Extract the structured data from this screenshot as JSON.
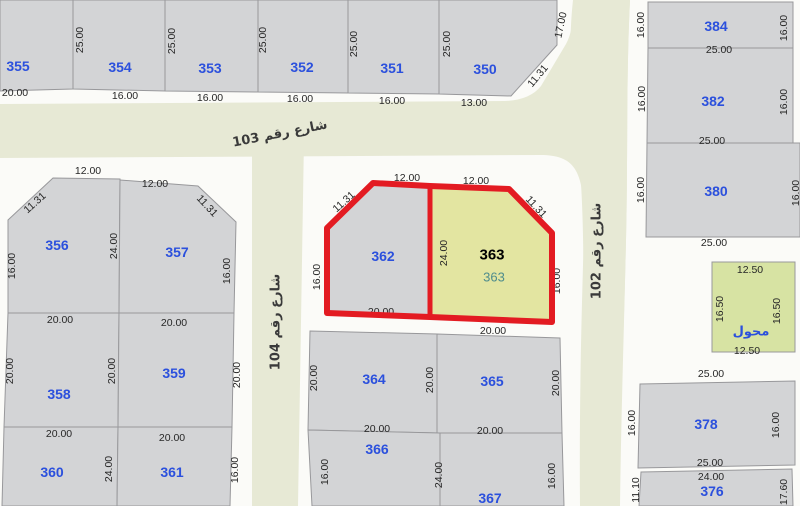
{
  "map": {
    "colors": {
      "ground": "#fbfbf8",
      "street_fill": "#e7e9d5",
      "plot": "#d3d4d6",
      "plot_stroke": "#98989b",
      "selected": "#e3e5a1",
      "utility": "#d7e3a3",
      "plot_number": "#2b50dd",
      "dim_text": "#272727",
      "street_text": "#3a3a3a",
      "highlight": "#e31b22",
      "selected_number": "#000000",
      "selected_sub": "#4e8c8c"
    },
    "streets": [
      {
        "id": "103-102",
        "label": "شارع رقم 103",
        "shape": "M0,104 L505,101 Q530,100 541,86 L566,44 Q572,33 573,16 L573,0 L630,0 C626,80 628,160 626,240 C624,330 621,420 620,506 L580,506 C579,400 582,300 584,230 C585,170 575,155 540,155 L0,158 Z",
        "label_x": 280,
        "label_y": 134,
        "label_rot": -11
      },
      {
        "id": "102",
        "label": "شارع رقم 102",
        "shape": "M573,0 C567,55 572,120 580,170 C585,230 584,330 582,506 L619,506 C620,420 624,330 626,240 C628,160 626,80 630,0 Z",
        "label_x": 597,
        "label_y": 251,
        "label_rot": -90
      },
      {
        "id": "104",
        "label": "شارع رقم 104",
        "shape": "M252,138 L304,138 L298,506 L252,506 Z",
        "label_x": 276,
        "label_y": 322,
        "label_rot": -90
      }
    ],
    "plots": [
      {
        "id": "355",
        "points": "0,0 73,0 73,89 0,91",
        "num": "355",
        "nx": 18,
        "ny": 66
      },
      {
        "id": "354",
        "points": "73,0 165,0 165,91 73,89",
        "num": "354",
        "nx": 120,
        "ny": 67
      },
      {
        "id": "353",
        "points": "165,0 258,0 258,92 165,91",
        "num": "353",
        "nx": 210,
        "ny": 68
      },
      {
        "id": "352",
        "points": "258,0 348,0 348,93 258,92",
        "num": "352",
        "nx": 302,
        "ny": 67
      },
      {
        "id": "351",
        "points": "348,0 439,0 439,94 348,93",
        "num": "351",
        "nx": 392,
        "ny": 68
      },
      {
        "id": "350",
        "points": "439,0 557,0 557,45 511,96 439,94",
        "num": "350",
        "nx": 485,
        "ny": 69
      },
      {
        "id": "384",
        "points": "648,2 793,2 793,48 648,48",
        "num": "384",
        "nx": 716,
        "ny": 26
      },
      {
        "id": "382",
        "points": "648,48 793,48 793,143 647,143",
        "num": "382",
        "nx": 713,
        "ny": 101
      },
      {
        "id": "380",
        "points": "647,143 800,143 800,237 646,237",
        "num": "380",
        "nx": 716,
        "ny": 191
      },
      {
        "id": "transformer",
        "points": "712,262 795,262 795,352 712,352",
        "fill": "utility",
        "num": "محول",
        "nx": 751,
        "ny": 332,
        "arabic": true
      },
      {
        "id": "378",
        "points": "640,384 795,381 795,465 638,468",
        "num": "378",
        "nx": 706,
        "ny": 424
      },
      {
        "id": "376",
        "points": "641,472 792,469 793,506 639,506",
        "num": "376",
        "nx": 712,
        "ny": 491
      },
      {
        "id": "356",
        "points": "8,220 53,178 120,179 119,313 8,313",
        "num": "356",
        "nx": 57,
        "ny": 245
      },
      {
        "id": "357",
        "points": "120,180 198,186 236,222 234,313 119,313",
        "num": "357",
        "nx": 177,
        "ny": 252
      },
      {
        "id": "358",
        "points": "8,313 119,313 118,427 4,427",
        "num": "358",
        "nx": 59,
        "ny": 394
      },
      {
        "id": "359",
        "points": "119,313 234,313 232,427 118,427",
        "num": "359",
        "nx": 174,
        "ny": 373
      },
      {
        "id": "360",
        "points": "4,427 118,427 117,506 2,506",
        "num": "360",
        "nx": 52,
        "ny": 472
      },
      {
        "id": "361",
        "points": "118,427 232,427 230,506 117,506",
        "num": "361",
        "nx": 172,
        "ny": 472
      },
      {
        "id": "362",
        "points": "327,228 373,183 430,186 430,317 327,313",
        "num": "362",
        "nx": 383,
        "ny": 256
      },
      {
        "id": "363",
        "points": "430,186 509,189 552,233 552,322 430,317",
        "fill": "selected"
      },
      {
        "id": "364",
        "points": "310,331 437,334 437,433 308,430",
        "num": "364",
        "nx": 374,
        "ny": 379
      },
      {
        "id": "365",
        "points": "437,334 560,338 562,433 437,433",
        "num": "365",
        "nx": 492,
        "ny": 381
      },
      {
        "id": "366",
        "points": "308,430 440,433 440,506 312,506",
        "num": "366",
        "nx": 377,
        "ny": 449
      },
      {
        "id": "367",
        "points": "440,433 562,433 564,506 440,506",
        "num": "367",
        "nx": 490,
        "ny": 498
      }
    ],
    "dims": [
      {
        "t": "20.00",
        "x": 15,
        "y": 93
      },
      {
        "t": "16.00",
        "x": 125,
        "y": 96
      },
      {
        "t": "16.00",
        "x": 210,
        "y": 98
      },
      {
        "t": "16.00",
        "x": 300,
        "y": 99
      },
      {
        "t": "16.00",
        "x": 392,
        "y": 101
      },
      {
        "t": "13.00",
        "x": 474,
        "y": 103
      },
      {
        "t": "25.00",
        "x": 80,
        "y": 40,
        "r": -90
      },
      {
        "t": "25.00",
        "x": 172,
        "y": 41,
        "r": -90
      },
      {
        "t": "25.00",
        "x": 263,
        "y": 40,
        "r": -90
      },
      {
        "t": "25.00",
        "x": 354,
        "y": 44,
        "r": -90
      },
      {
        "t": "25.00",
        "x": 447,
        "y": 44,
        "r": -90
      },
      {
        "t": "11.31",
        "x": 538,
        "y": 76,
        "r": -50
      },
      {
        "t": "17.00",
        "x": 561,
        "y": 25,
        "r": -78
      },
      {
        "t": "16.00",
        "x": 641,
        "y": 25,
        "r": -90
      },
      {
        "t": "16.00",
        "x": 784,
        "y": 28,
        "r": -90
      },
      {
        "t": "25.00",
        "x": 719,
        "y": 50
      },
      {
        "t": "16.00",
        "x": 642,
        "y": 99,
        "r": -90
      },
      {
        "t": "16.00",
        "x": 784,
        "y": 102,
        "r": -90
      },
      {
        "t": "25.00",
        "x": 712,
        "y": 141
      },
      {
        "t": "16.00",
        "x": 641,
        "y": 190,
        "r": -90
      },
      {
        "t": "16.00",
        "x": 796,
        "y": 193,
        "r": -90
      },
      {
        "t": "25.00",
        "x": 714,
        "y": 243
      },
      {
        "t": "12.50",
        "x": 750,
        "y": 270
      },
      {
        "t": "16.50",
        "x": 720,
        "y": 309,
        "r": -90
      },
      {
        "t": "16.50",
        "x": 777,
        "y": 311,
        "r": -90
      },
      {
        "t": "12.50",
        "x": 747,
        "y": 351
      },
      {
        "t": "25.00",
        "x": 711,
        "y": 374
      },
      {
        "t": "16.00",
        "x": 632,
        "y": 423,
        "r": -90
      },
      {
        "t": "16.00",
        "x": 776,
        "y": 425,
        "r": -90
      },
      {
        "t": "25.00",
        "x": 710,
        "y": 463
      },
      {
        "t": "24.00",
        "x": 711,
        "y": 477
      },
      {
        "t": "11.10",
        "x": 636,
        "y": 490,
        "r": -90
      },
      {
        "t": "17.60",
        "x": 784,
        "y": 492,
        "r": -90
      },
      {
        "t": "12.00",
        "x": 88,
        "y": 171
      },
      {
        "t": "11.31",
        "x": 35,
        "y": 203,
        "r": -42
      },
      {
        "t": "12.00",
        "x": 155,
        "y": 184
      },
      {
        "t": "11.31",
        "x": 207,
        "y": 206,
        "r": 47
      },
      {
        "t": "24.00",
        "x": 114,
        "y": 246,
        "r": -90
      },
      {
        "t": "16.00",
        "x": 12,
        "y": 266,
        "r": -90
      },
      {
        "t": "16.00",
        "x": 227,
        "y": 271,
        "r": -90
      },
      {
        "t": "20.00",
        "x": 60,
        "y": 320
      },
      {
        "t": "20.00",
        "x": 174,
        "y": 323
      },
      {
        "t": "20.00",
        "x": 10,
        "y": 371,
        "r": -90
      },
      {
        "t": "20.00",
        "x": 112,
        "y": 371,
        "r": -90
      },
      {
        "t": "20.00",
        "x": 237,
        "y": 375,
        "r": -90
      },
      {
        "t": "20.00",
        "x": 59,
        "y": 434
      },
      {
        "t": "20.00",
        "x": 172,
        "y": 438
      },
      {
        "t": "24.00",
        "x": 109,
        "y": 469,
        "r": -90
      },
      {
        "t": "16.00",
        "x": 235,
        "y": 470,
        "r": -90
      },
      {
        "t": "12.00",
        "x": 407,
        "y": 178
      },
      {
        "t": "11.31",
        "x": 344,
        "y": 202,
        "r": -42
      },
      {
        "t": "12.00",
        "x": 476,
        "y": 181
      },
      {
        "t": "11.31",
        "x": 536,
        "y": 207,
        "r": 47
      },
      {
        "t": "24.00",
        "x": 444,
        "y": 253,
        "r": -90
      },
      {
        "t": "16.00",
        "x": 317,
        "y": 277,
        "r": -90
      },
      {
        "t": "16.00",
        "x": 557,
        "y": 281,
        "r": -90
      },
      {
        "t": "20.00",
        "x": 381,
        "y": 312
      },
      {
        "t": "20.00",
        "x": 493,
        "y": 331
      },
      {
        "t": "20.00",
        "x": 314,
        "y": 378,
        "r": -90
      },
      {
        "t": "20.00",
        "x": 430,
        "y": 380,
        "r": -90
      },
      {
        "t": "20.00",
        "x": 556,
        "y": 383,
        "r": -90
      },
      {
        "t": "20.00",
        "x": 377,
        "y": 429
      },
      {
        "t": "20.00",
        "x": 490,
        "y": 431
      },
      {
        "t": "16.00",
        "x": 325,
        "y": 472,
        "r": -90
      },
      {
        "t": "24.00",
        "x": 439,
        "y": 475,
        "r": -90
      },
      {
        "t": "16.00",
        "x": 552,
        "y": 476,
        "r": -90
      }
    ],
    "highlight": {
      "outline": "373,183 430,186 509,189 552,233 552,322 430,317 327,313 327,228",
      "divider": {
        "x1": 430,
        "y1": 186,
        "x2": 430,
        "y2": 317
      },
      "stroke_width": 6,
      "selected": {
        "number": "363",
        "x": 492,
        "y": 255,
        "sub": "363",
        "sub_x": 494,
        "sub_y": 277
      }
    }
  }
}
